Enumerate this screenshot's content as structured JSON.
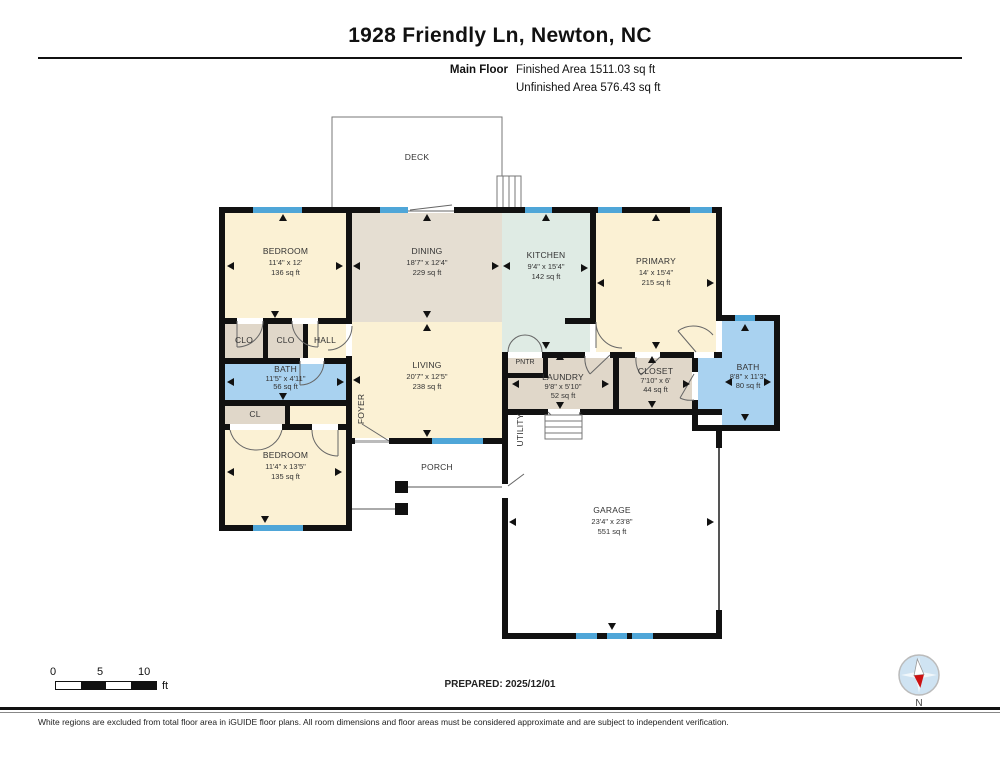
{
  "header": {
    "title": "1928 Friendly Ln, Newton, NC",
    "floor_label": "Main Floor",
    "finished_area": "Finished Area 1511.03 sq ft",
    "unfinished_area": "Unfinished Area 576.43 sq ft"
  },
  "rooms": {
    "deck": {
      "name": "DECK"
    },
    "bedroom_tl": {
      "name": "BEDROOM",
      "dims": "11'4\" x 12'",
      "area": "136 sq ft"
    },
    "dining": {
      "name": "DINING",
      "dims": "18'7\" x 12'4\"",
      "area": "229 sq ft"
    },
    "kitchen": {
      "name": "KITCHEN",
      "dims": "9'4\" x 15'4\"",
      "area": "142 sq ft"
    },
    "primary": {
      "name": "PRIMARY",
      "dims": "14' x 15'4\"",
      "area": "215 sq ft"
    },
    "bath_left": {
      "name": "BATH",
      "dims": "11'5\" x 4'11\"",
      "area": "56 sq ft"
    },
    "living": {
      "name": "LIVING",
      "dims": "20'7\" x 12'5\"",
      "area": "238 sq ft"
    },
    "laundry": {
      "name": "LAUNDRY",
      "dims": "9'8\" x 5'10\"",
      "area": "52 sq ft"
    },
    "closet": {
      "name": "CLOSET",
      "dims": "7'10\" x 6'",
      "area": "44 sq ft"
    },
    "bath_right": {
      "name": "BATH",
      "dims": "8'8\" x 11'3\"",
      "area": "80 sq ft"
    },
    "bedroom_bl": {
      "name": "BEDROOM",
      "dims": "11'4\" x 13'5\"",
      "area": "135 sq ft"
    },
    "garage": {
      "name": "GARAGE",
      "dims": "23'4\" x 23'8\"",
      "area": "551 sq ft"
    },
    "clo1": {
      "name": "CLO"
    },
    "clo2": {
      "name": "CLO"
    },
    "hall": {
      "name": "HALL"
    },
    "cl": {
      "name": "CL"
    },
    "pntr": {
      "name": "PNTR"
    },
    "foyer": {
      "name": "FOYER"
    },
    "utility": {
      "name": "UTILITY"
    },
    "porch": {
      "name": "PORCH"
    }
  },
  "footer": {
    "scale_ticks": {
      "t0": "0",
      "t5": "5",
      "t10": "10",
      "unit": "ft"
    },
    "prepared": "PREPARED: 2025/12/01",
    "compass_label": "N",
    "disclaimer": "White regions are excluded from total floor area in iGUIDE floor plans. All room dimensions and floor areas must be considered approximate and are subject to independent verification."
  },
  "colors": {
    "wall": "#111111",
    "window_blue": "#4FA6D8",
    "room_cream": "#FBF1D4",
    "room_tan_dining": "#E5DED2",
    "room_tan_closet": "#E0D7C9",
    "room_mint": "#DFEBE4",
    "room_bath_blue": "#A9D2F0",
    "compass_red": "#CC1111",
    "compass_blue": "#CFE3F2"
  }
}
